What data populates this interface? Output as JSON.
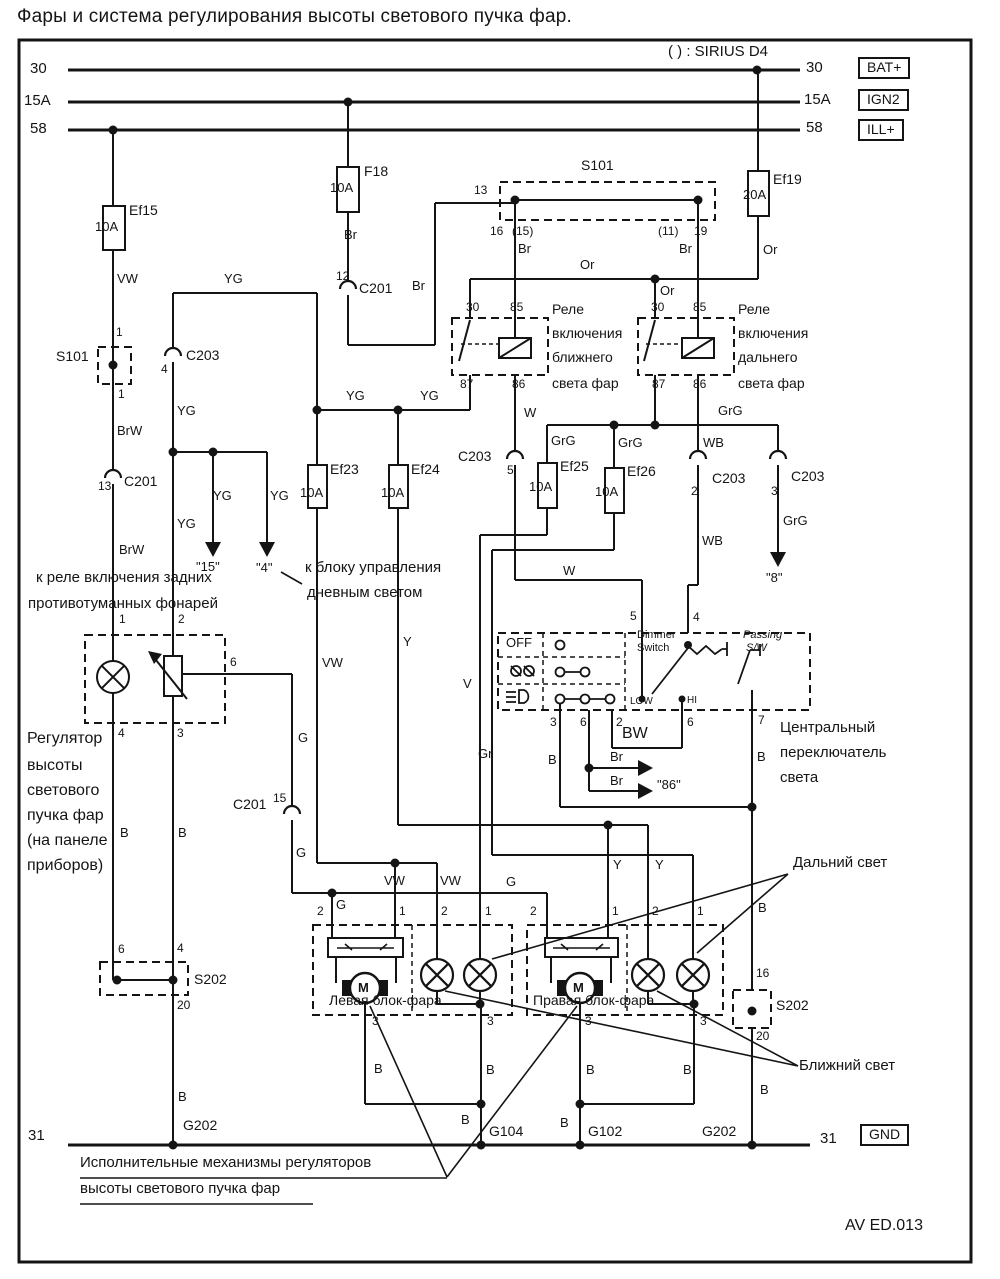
{
  "title": "Фары и система регулирования высоты светового пучка фар.",
  "labels": [
    {
      "n": "sirius-note",
      "t": "( ) : SIRIUS D4",
      "x": 668,
      "y": 44,
      "s": 15
    },
    {
      "n": "bus-30-left",
      "t": "30",
      "x": 30,
      "y": 61,
      "s": 15
    },
    {
      "n": "bus-15a-left",
      "t": "15A",
      "x": 24,
      "y": 93,
      "s": 15
    },
    {
      "n": "bus-58-left",
      "t": "58",
      "x": 30,
      "y": 121,
      "s": 15
    },
    {
      "n": "bus-30-right",
      "t": "30",
      "x": 806,
      "y": 60,
      "s": 15
    },
    {
      "n": "bus-15a-right",
      "t": "15A",
      "x": 804,
      "y": 92,
      "s": 15
    },
    {
      "n": "bus-58-right",
      "t": "58",
      "x": 806,
      "y": 120,
      "s": 15
    },
    {
      "n": "bat-plus-box",
      "t": "BAT+",
      "x": 858,
      "y": 57,
      "s": 14,
      "box": 1
    },
    {
      "n": "ign2-box",
      "t": "IGN2",
      "x": 858,
      "y": 89,
      "s": 14,
      "box": 1
    },
    {
      "n": "ill-plus-box",
      "t": "ILL+",
      "x": 858,
      "y": 119,
      "s": 14,
      "box": 1
    },
    {
      "n": "bus-31-left",
      "t": "31",
      "x": 28,
      "y": 1128,
      "s": 15
    },
    {
      "n": "bus-31-right",
      "t": "31",
      "x": 820,
      "y": 1131,
      "s": 15
    },
    {
      "n": "gnd-box",
      "t": "GND",
      "x": 860,
      "y": 1124,
      "s": 14,
      "box": 1
    },
    {
      "n": "fuse-ef15-name",
      "t": "Ef15",
      "x": 129,
      "y": 203,
      "s": 14
    },
    {
      "n": "fuse-ef15-rating",
      "t": "10A",
      "x": 95,
      "y": 220,
      "s": 13
    },
    {
      "n": "fuse-f18-name",
      "t": "F18",
      "x": 364,
      "y": 164,
      "s": 14
    },
    {
      "n": "fuse-f18-rating",
      "t": "10A",
      "x": 330,
      "y": 181,
      "s": 13
    },
    {
      "n": "fuse-ef19-name",
      "t": "Ef19",
      "x": 773,
      "y": 172,
      "s": 14
    },
    {
      "n": "fuse-ef19-rating",
      "t": "20A",
      "x": 743,
      "y": 188,
      "s": 13
    },
    {
      "n": "fuse-ef23-name",
      "t": "Ef23",
      "x": 330,
      "y": 462,
      "s": 14
    },
    {
      "n": "fuse-ef23-rating",
      "t": "10A",
      "x": 300,
      "y": 486,
      "s": 13
    },
    {
      "n": "fuse-ef24-name",
      "t": "Ef24",
      "x": 411,
      "y": 462,
      "s": 14
    },
    {
      "n": "fuse-ef24-rating",
      "t": "10A",
      "x": 381,
      "y": 486,
      "s": 13
    },
    {
      "n": "fuse-ef25-name",
      "t": "Ef25",
      "x": 560,
      "y": 459,
      "s": 14
    },
    {
      "n": "fuse-ef25-rating",
      "t": "10A",
      "x": 529,
      "y": 480,
      "s": 13
    },
    {
      "n": "fuse-ef26-name",
      "t": "Ef26",
      "x": 627,
      "y": 464,
      "s": 14
    },
    {
      "n": "fuse-ef26-rating",
      "t": "10A",
      "x": 595,
      "y": 485,
      "s": 13
    },
    {
      "n": "wire-vw-1",
      "t": "VW",
      "x": 117,
      "y": 272,
      "s": 13
    },
    {
      "n": "wire-brw-1",
      "t": "BrW",
      "x": 117,
      "y": 424,
      "s": 13
    },
    {
      "n": "wire-brw-2",
      "t": "BrW",
      "x": 119,
      "y": 543,
      "s": 13
    },
    {
      "n": "splice-s101-left",
      "t": "S101",
      "x": 56,
      "y": 349,
      "s": 14
    },
    {
      "n": "s101-left-pin1",
      "t": "1",
      "x": 116,
      "y": 326,
      "s": 12
    },
    {
      "n": "s101-left-pin3",
      "t": "1",
      "x": 118,
      "y": 388,
      "s": 12
    },
    {
      "n": "conn-c201-13-pin",
      "t": "13",
      "x": 98,
      "y": 480,
      "s": 12
    },
    {
      "n": "conn-c201-13",
      "t": "C201",
      "x": 124,
      "y": 474,
      "s": 14
    },
    {
      "n": "conn-c201-12-pin",
      "t": "12",
      "x": 336,
      "y": 270,
      "s": 12
    },
    {
      "n": "conn-c201-12",
      "t": "C201",
      "x": 359,
      "y": 281,
      "s": 14
    },
    {
      "n": "wire-br-f18",
      "t": "Br",
      "x": 344,
      "y": 228,
      "s": 13
    },
    {
      "n": "wire-br-feed",
      "t": "Br",
      "x": 412,
      "y": 279,
      "s": 13
    },
    {
      "n": "splice-s101-top",
      "t": "S101",
      "x": 581,
      "y": 158,
      "s": 14
    },
    {
      "n": "s101-pin13",
      "t": "13",
      "x": 474,
      "y": 184,
      "s": 12
    },
    {
      "n": "s101-pin16",
      "t": "16",
      "x": 490,
      "y": 225,
      "s": 12
    },
    {
      "n": "s101-pin15p",
      "t": "(15)",
      "x": 512,
      "y": 225,
      "s": 12
    },
    {
      "n": "wire-br-s101l",
      "t": "Br",
      "x": 518,
      "y": 242,
      "s": 13
    },
    {
      "n": "s101-pin11p",
      "t": "(11)",
      "x": 658,
      "y": 225,
      "s": 12
    },
    {
      "n": "s101-pin19",
      "t": "19",
      "x": 694,
      "y": 225,
      "s": 12
    },
    {
      "n": "wire-br-s101r",
      "t": "Br",
      "x": 679,
      "y": 242,
      "s": 13
    },
    {
      "n": "wire-or-bus",
      "t": "Or",
      "x": 580,
      "y": 258,
      "s": 13
    },
    {
      "n": "wire-or-2",
      "t": "Or",
      "x": 660,
      "y": 284,
      "s": 13
    },
    {
      "n": "wire-or-3",
      "t": "Or",
      "x": 763,
      "y": 243,
      "s": 13
    },
    {
      "n": "wire-yg-top",
      "t": "YG",
      "x": 224,
      "y": 272,
      "s": 13
    },
    {
      "n": "conn-c203-4-pin",
      "t": "4",
      "x": 161,
      "y": 363,
      "s": 12
    },
    {
      "n": "conn-c203-4",
      "t": "C203",
      "x": 186,
      "y": 348,
      "s": 14
    },
    {
      "n": "wire-yg-2",
      "t": "YG",
      "x": 177,
      "y": 404,
      "s": 13
    },
    {
      "n": "wire-yg-3",
      "t": "YG",
      "x": 213,
      "y": 489,
      "s": 13
    },
    {
      "n": "wire-yg-4",
      "t": "YG",
      "x": 270,
      "y": 489,
      "s": 13
    },
    {
      "n": "wire-yg-5",
      "t": "YG",
      "x": 177,
      "y": 517,
      "s": 13
    },
    {
      "n": "wire-yg-6",
      "t": "YG",
      "x": 346,
      "y": 389,
      "s": 13
    },
    {
      "n": "wire-yg-7",
      "t": "YG",
      "x": 420,
      "y": 389,
      "s": 13
    },
    {
      "n": "ref-arrow-15",
      "t": "\"15\"",
      "x": 196,
      "y": 560,
      "s": 13
    },
    {
      "n": "ref-arrow-4",
      "t": "\"4\"",
      "x": 256,
      "y": 561,
      "s": 13
    },
    {
      "n": "drl-note-line1",
      "t": "к блоку управления",
      "x": 305,
      "y": 560,
      "s": 15
    },
    {
      "n": "drl-note-line2",
      "t": "дневным светом",
      "x": 307,
      "y": 585,
      "s": 15
    },
    {
      "n": "fog-note-line1",
      "t": "к реле включения задних",
      "x": 36,
      "y": 570,
      "s": 15
    },
    {
      "n": "fog-note-line2",
      "t": "противотуманных фонарей",
      "x": 28,
      "y": 596,
      "s": 15
    },
    {
      "n": "relay-low-line1",
      "t": "Реле",
      "x": 552,
      "y": 302,
      "s": 14
    },
    {
      "n": "relay-low-line2",
      "t": "включения",
      "x": 552,
      "y": 326,
      "s": 14
    },
    {
      "n": "relay-low-line3",
      "t": "ближнего",
      "x": 552,
      "y": 350,
      "s": 14
    },
    {
      "n": "relay-low-line4",
      "t": "света фар",
      "x": 552,
      "y": 376,
      "s": 14
    },
    {
      "n": "relay-high-line1",
      "t": "Реле",
      "x": 738,
      "y": 302,
      "s": 14
    },
    {
      "n": "relay-high-line2",
      "t": "включения",
      "x": 738,
      "y": 326,
      "s": 14
    },
    {
      "n": "relay-high-line3",
      "t": "дальнего",
      "x": 738,
      "y": 350,
      "s": 14
    },
    {
      "n": "relay-high-line4",
      "t": "света фар",
      "x": 738,
      "y": 376,
      "s": 14
    },
    {
      "n": "relay1-pin30",
      "t": "30",
      "x": 466,
      "y": 301,
      "s": 12
    },
    {
      "n": "relay1-pin85",
      "t": "85",
      "x": 510,
      "y": 301,
      "s": 12
    },
    {
      "n": "relay1-pin87",
      "t": "87",
      "x": 460,
      "y": 378,
      "s": 12
    },
    {
      "n": "relay1-pin86",
      "t": "86",
      "x": 512,
      "y": 378,
      "s": 12
    },
    {
      "n": "relay2-pin30",
      "t": "30",
      "x": 651,
      "y": 301,
      "s": 12
    },
    {
      "n": "relay2-pin85",
      "t": "85",
      "x": 693,
      "y": 301,
      "s": 12
    },
    {
      "n": "relay2-pin87",
      "t": "87",
      "x": 652,
      "y": 378,
      "s": 12
    },
    {
      "n": "relay2-pin86",
      "t": "86",
      "x": 693,
      "y": 378,
      "s": 12
    },
    {
      "n": "wire-w-1",
      "t": "W",
      "x": 524,
      "y": 406,
      "s": 13
    },
    {
      "n": "wire-w-2",
      "t": "W",
      "x": 563,
      "y": 564,
      "s": 13
    },
    {
      "n": "conn-c203-5-pin",
      "t": "5",
      "x": 507,
      "y": 464,
      "s": 12
    },
    {
      "n": "conn-c203-5",
      "t": "C203",
      "x": 458,
      "y": 449,
      "s": 14
    },
    {
      "n": "wire-grg-1",
      "t": "GrG",
      "x": 551,
      "y": 434,
      "s": 13
    },
    {
      "n": "wire-grg-2",
      "t": "GrG",
      "x": 618,
      "y": 436,
      "s": 13
    },
    {
      "n": "wire-grg-3",
      "t": "GrG",
      "x": 718,
      "y": 404,
      "s": 13
    },
    {
      "n": "wire-grg-4",
      "t": "GrG",
      "x": 783,
      "y": 514,
      "s": 13
    },
    {
      "n": "wire-wb-1",
      "t": "WB",
      "x": 703,
      "y": 436,
      "s": 13
    },
    {
      "n": "wire-wb-2",
      "t": "WB",
      "x": 702,
      "y": 534,
      "s": 13
    },
    {
      "n": "conn-c203-2-pin",
      "t": "2",
      "x": 691,
      "y": 485,
      "s": 12
    },
    {
      "n": "conn-c203-2",
      "t": "C203",
      "x": 712,
      "y": 471,
      "s": 14
    },
    {
      "n": "conn-c203-3-pin",
      "t": "3",
      "x": 771,
      "y": 485,
      "s": 12
    },
    {
      "n": "conn-c203-3",
      "t": "C203",
      "x": 791,
      "y": 469,
      "s": 14
    },
    {
      "n": "ref-arrow-8",
      "t": "\"8\"",
      "x": 766,
      "y": 571,
      "s": 13
    },
    {
      "n": "regulator-line1",
      "t": "Регулятор",
      "x": 27,
      "y": 731,
      "s": 16
    },
    {
      "n": "regulator-line2",
      "t": "высоты",
      "x": 27,
      "y": 758,
      "s": 16
    },
    {
      "n": "regulator-line3",
      "t": "светового",
      "x": 27,
      "y": 783,
      "s": 16
    },
    {
      "n": "regulator-line4",
      "t": "пучка фар",
      "x": 27,
      "y": 808,
      "s": 16
    },
    {
      "n": "regulator-line5",
      "t": "(на панеле",
      "x": 27,
      "y": 833,
      "s": 16
    },
    {
      "n": "regulator-line6",
      "t": "приборов)",
      "x": 27,
      "y": 858,
      "s": 16
    },
    {
      "n": "reg-pin1",
      "t": "1",
      "x": 119,
      "y": 613,
      "s": 12
    },
    {
      "n": "reg-pin2",
      "t": "2",
      "x": 178,
      "y": 613,
      "s": 12
    },
    {
      "n": "reg-pin4",
      "t": "4",
      "x": 118,
      "y": 727,
      "s": 12
    },
    {
      "n": "reg-pin3",
      "t": "3",
      "x": 177,
      "y": 727,
      "s": 12
    },
    {
      "n": "reg-pin6",
      "t": "6",
      "x": 230,
      "y": 656,
      "s": 12
    },
    {
      "n": "conn-c201-15",
      "t": "C201",
      "x": 233,
      "y": 797,
      "s": 14
    },
    {
      "n": "conn-c201-15-pin",
      "t": "15",
      "x": 273,
      "y": 792,
      "s": 12
    },
    {
      "n": "wire-g-1",
      "t": "G",
      "x": 298,
      "y": 731,
      "s": 13
    },
    {
      "n": "wire-g-2",
      "t": "G",
      "x": 296,
      "y": 846,
      "s": 13
    },
    {
      "n": "wire-g-3",
      "t": "G",
      "x": 336,
      "y": 898,
      "s": 13
    },
    {
      "n": "wire-g-4",
      "t": "G",
      "x": 506,
      "y": 875,
      "s": 13
    },
    {
      "n": "wire-b-left1",
      "t": "B",
      "x": 120,
      "y": 826,
      "s": 13
    },
    {
      "n": "wire-b-left2",
      "t": "B",
      "x": 178,
      "y": 826,
      "s": 13
    },
    {
      "n": "s202l-pin6",
      "t": "6",
      "x": 118,
      "y": 943,
      "s": 12
    },
    {
      "n": "s202l-pin4",
      "t": "4",
      "x": 177,
      "y": 942,
      "s": 12
    },
    {
      "n": "splice-s202-left",
      "t": "S202",
      "x": 194,
      "y": 972,
      "s": 14
    },
    {
      "n": "s202l-pin20",
      "t": "20",
      "x": 177,
      "y": 999,
      "s": 12
    },
    {
      "n": "wire-b-left3",
      "t": "B",
      "x": 178,
      "y": 1090,
      "s": 13
    },
    {
      "n": "ground-g202-left",
      "t": "G202",
      "x": 183,
      "y": 1118,
      "s": 14
    },
    {
      "n": "switch-off",
      "t": "OFF",
      "x": 506,
      "y": 636,
      "s": 13
    },
    {
      "n": "dimmer-label1",
      "t": "Dimmer",
      "x": 637,
      "y": 630,
      "s": 11
    },
    {
      "n": "dimmer-label2",
      "t": "Switch",
      "x": 637,
      "y": 643,
      "s": 11
    },
    {
      "n": "passing-label1",
      "t": "Passing",
      "x": 743,
      "y": 630,
      "s": 11,
      "it": 1
    },
    {
      "n": "passing-label2",
      "t": "S/W",
      "x": 746,
      "y": 643,
      "s": 11,
      "it": 1
    },
    {
      "n": "dimmer-low",
      "t": "LOW",
      "x": 630,
      "y": 697,
      "s": 10
    },
    {
      "n": "dimmer-hi",
      "t": "HI",
      "x": 687,
      "y": 696,
      "s": 10
    },
    {
      "n": "switch-pin5",
      "t": "5",
      "x": 630,
      "y": 610,
      "s": 12
    },
    {
      "n": "switch-pin4",
      "t": "4",
      "x": 693,
      "y": 611,
      "s": 12
    },
    {
      "n": "switch-pin3",
      "t": "3",
      "x": 550,
      "y": 716,
      "s": 12
    },
    {
      "n": "switch-pin6a",
      "t": "6",
      "x": 580,
      "y": 716,
      "s": 12
    },
    {
      "n": "switch-pin2",
      "t": "2",
      "x": 616,
      "y": 716,
      "s": 12
    },
    {
      "n": "switch-pin6b",
      "t": "6",
      "x": 687,
      "y": 716,
      "s": 12
    },
    {
      "n": "switch-pin7",
      "t": "7",
      "x": 758,
      "y": 714,
      "s": 12
    },
    {
      "n": "wire-bw",
      "t": "BW",
      "x": 622,
      "y": 726,
      "s": 16
    },
    {
      "n": "wire-gr",
      "t": "Gr",
      "x": 478,
      "y": 747,
      "s": 13
    },
    {
      "n": "wire-b-sw1",
      "t": "B",
      "x": 548,
      "y": 753,
      "s": 13
    },
    {
      "n": "wire-br-arrow1",
      "t": "Br",
      "x": 610,
      "y": 750,
      "s": 13
    },
    {
      "n": "wire-br-arrow2",
      "t": "Br",
      "x": 610,
      "y": 774,
      "s": 13
    },
    {
      "n": "ref-arrow-86",
      "t": "\"86\"",
      "x": 657,
      "y": 778,
      "s": 13
    },
    {
      "n": "wire-b-sw2",
      "t": "B",
      "x": 757,
      "y": 750,
      "s": 13
    },
    {
      "n": "central-switch-line1",
      "t": "Центральный",
      "x": 780,
      "y": 720,
      "s": 15
    },
    {
      "n": "central-switch-line2",
      "t": "переключатель",
      "x": 780,
      "y": 745,
      "s": 15
    },
    {
      "n": "central-switch-line3",
      "t": "света",
      "x": 780,
      "y": 770,
      "s": 15
    },
    {
      "n": "wire-v",
      "t": "V",
      "x": 463,
      "y": 677,
      "s": 13
    },
    {
      "n": "wire-vw-2",
      "t": "VW",
      "x": 322,
      "y": 656,
      "s": 13
    },
    {
      "n": "wire-y-1",
      "t": "Y",
      "x": 403,
      "y": 635,
      "s": 13
    },
    {
      "n": "wire-vw-3",
      "t": "VW",
      "x": 384,
      "y": 874,
      "s": 13
    },
    {
      "n": "wire-vw-4",
      "t": "VW",
      "x": 440,
      "y": 874,
      "s": 13
    },
    {
      "n": "wire-y-2",
      "t": "Y",
      "x": 613,
      "y": 858,
      "s": 13
    },
    {
      "n": "wire-y-3",
      "t": "Y",
      "x": 655,
      "y": 858,
      "s": 13
    },
    {
      "n": "hl-pin2a",
      "t": "2",
      "x": 317,
      "y": 905,
      "s": 12
    },
    {
      "n": "hl-pin1a",
      "t": "1",
      "x": 399,
      "y": 905,
      "s": 12
    },
    {
      "n": "hl-pin2b",
      "t": "2",
      "x": 441,
      "y": 905,
      "s": 12
    },
    {
      "n": "hl-pin1b",
      "t": "1",
      "x": 485,
      "y": 905,
      "s": 12
    },
    {
      "n": "hl-pin2c",
      "t": "2",
      "x": 530,
      "y": 905,
      "s": 12
    },
    {
      "n": "hl-pin1c",
      "t": "1",
      "x": 612,
      "y": 905,
      "s": 12
    },
    {
      "n": "hl-pin2d",
      "t": "2",
      "x": 652,
      "y": 905,
      "s": 12
    },
    {
      "n": "hl-pin1d",
      "t": "1",
      "x": 697,
      "y": 905,
      "s": 12
    },
    {
      "n": "hl-pin3a",
      "t": "3",
      "x": 372,
      "y": 1015,
      "s": 12
    },
    {
      "n": "hl-pin3b",
      "t": "3",
      "x": 487,
      "y": 1015,
      "s": 12
    },
    {
      "n": "hl-pin3c",
      "t": "3",
      "x": 585,
      "y": 1015,
      "s": 12
    },
    {
      "n": "hl-pin3d",
      "t": "3",
      "x": 700,
      "y": 1015,
      "s": 12
    },
    {
      "n": "left-headlamp-label",
      "t": "Левая блок-фара",
      "x": 329,
      "y": 993,
      "s": 14
    },
    {
      "n": "right-headlamp-label",
      "t": "Правая блок-фара",
      "x": 533,
      "y": 993,
      "s": 14
    },
    {
      "n": "motor-m-left",
      "t": "M",
      "x": 358,
      "y": 981,
      "s": 13,
      "b": 1
    },
    {
      "n": "motor-m-right",
      "t": "M",
      "x": 573,
      "y": 981,
      "s": 13,
      "b": 1
    },
    {
      "n": "wire-b-1",
      "t": "B",
      "x": 374,
      "y": 1062,
      "s": 13
    },
    {
      "n": "wire-b-2",
      "t": "B",
      "x": 486,
      "y": 1063,
      "s": 13
    },
    {
      "n": "wire-b-3",
      "t": "B",
      "x": 586,
      "y": 1063,
      "s": 13
    },
    {
      "n": "wire-b-4",
      "t": "B",
      "x": 683,
      "y": 1063,
      "s": 13
    },
    {
      "n": "wire-b-5",
      "t": "B",
      "x": 758,
      "y": 901,
      "s": 13
    },
    {
      "n": "s202r-pin16",
      "t": "16",
      "x": 756,
      "y": 967,
      "s": 12
    },
    {
      "n": "splice-s202-right",
      "t": "S202",
      "x": 776,
      "y": 998,
      "s": 14
    },
    {
      "n": "s202r-pin20",
      "t": "20",
      "x": 756,
      "y": 1030,
      "s": 12
    },
    {
      "n": "wire-b-6",
      "t": "B",
      "x": 760,
      "y": 1083,
      "s": 13
    },
    {
      "n": "wire-b-7",
      "t": "B",
      "x": 461,
      "y": 1113,
      "s": 13
    },
    {
      "n": "wire-b-8",
      "t": "B",
      "x": 560,
      "y": 1116,
      "s": 13
    },
    {
      "n": "ground-g104",
      "t": "G104",
      "x": 489,
      "y": 1124,
      "s": 14
    },
    {
      "n": "ground-g102",
      "t": "G102",
      "x": 588,
      "y": 1124,
      "s": 14
    },
    {
      "n": "ground-g202-right",
      "t": "G202",
      "x": 702,
      "y": 1124,
      "s": 14
    },
    {
      "n": "high-beam-callout",
      "t": "Дальний свет",
      "x": 793,
      "y": 855,
      "s": 15
    },
    {
      "n": "low-beam-callout",
      "t": "Ближний свет",
      "x": 799,
      "y": 1058,
      "s": 15
    },
    {
      "n": "actuator-callout-line1",
      "t": "Исполнительные механизмы регуляторов",
      "x": 80,
      "y": 1155,
      "s": 15
    },
    {
      "n": "actuator-callout-line2",
      "t": "высоты светового пучка фар",
      "x": 80,
      "y": 1181,
      "s": 15
    },
    {
      "n": "diagram-code",
      "t": "AV ED.013",
      "x": 845,
      "y": 1218,
      "s": 16
    }
  ]
}
